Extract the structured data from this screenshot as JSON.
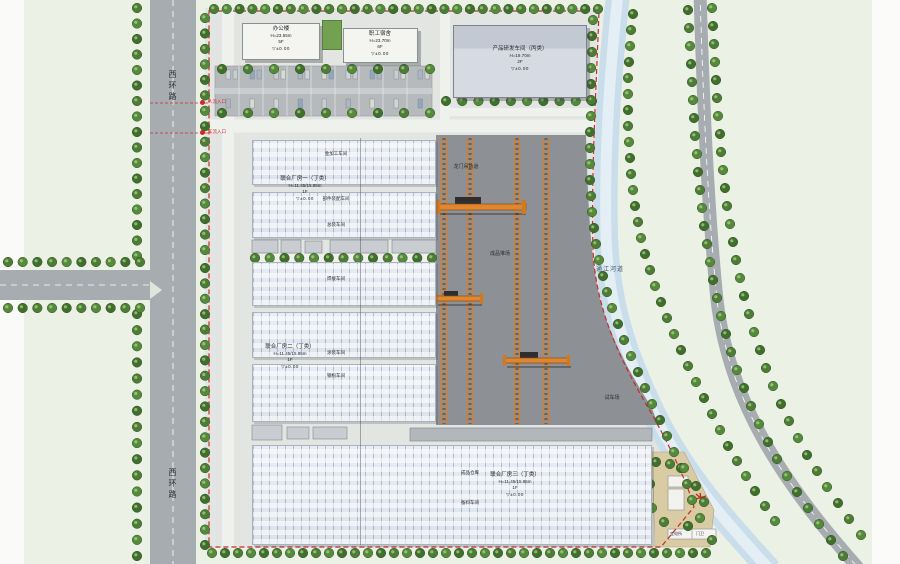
{
  "colors": {
    "ground": "#ecf1e6",
    "road": "#a7acb0",
    "river": "#c9ddeb",
    "river_hl": "#e4eef5",
    "site": "#e2e5e1",
    "yard": "#8d9195",
    "building": "#f4f5f1",
    "parking": "#b6babd",
    "tree": "#4c7c35",
    "tree_dark": "#2f5522",
    "boundary": "#cc2a2a",
    "crane": "#e0862f",
    "tan": "#d9cba3"
  },
  "roads": {
    "west_road": "西环路",
    "west_road_2": "西环路",
    "river": "通江河道"
  },
  "entrances": {
    "people": "人流入口",
    "vehicle": "车流入口"
  },
  "buildings": {
    "office": {
      "name": "办公楼",
      "height": "H=23.55m",
      "floors": "5F",
      "elev": "▽±0.00"
    },
    "dorm": {
      "name": "职工宿舍",
      "height": "H=23.70m",
      "floors": "6F",
      "elev": "▽±0.00"
    },
    "research": {
      "name": "产品研发车间（丙类）",
      "height": "H=19.70m",
      "floors": "2F",
      "elev": "▽±0.00"
    },
    "hall1": {
      "name": "联合厂房一（丁类）",
      "height": "H=11.45/15.95m",
      "floors": "1F",
      "elev": "▽±0.00"
    },
    "hall2": {
      "name": "联合厂房二（丁类）",
      "height": "H=11.45/15.95m",
      "floors": "1F",
      "elev": "▽±0.00"
    },
    "hall3": {
      "name": "联合厂房三（丁类）",
      "height": "H=11.45/15.95m",
      "floors": "1F",
      "elev": "▽±0.00"
    },
    "substation": "变电所",
    "gatehouse": "门卫"
  },
  "bays": {
    "b1": "金加工车间",
    "b2": "部件装配车间",
    "b3": "总装车间",
    "b4": "焊接车间",
    "b5": "涂装车间",
    "b6": "钢构车间",
    "b7": "成品仓库",
    "b8": "备料车间"
  },
  "yard": {
    "rail": "龙门吊轨道",
    "stock": "成品堆场",
    "test": "试车场"
  }
}
